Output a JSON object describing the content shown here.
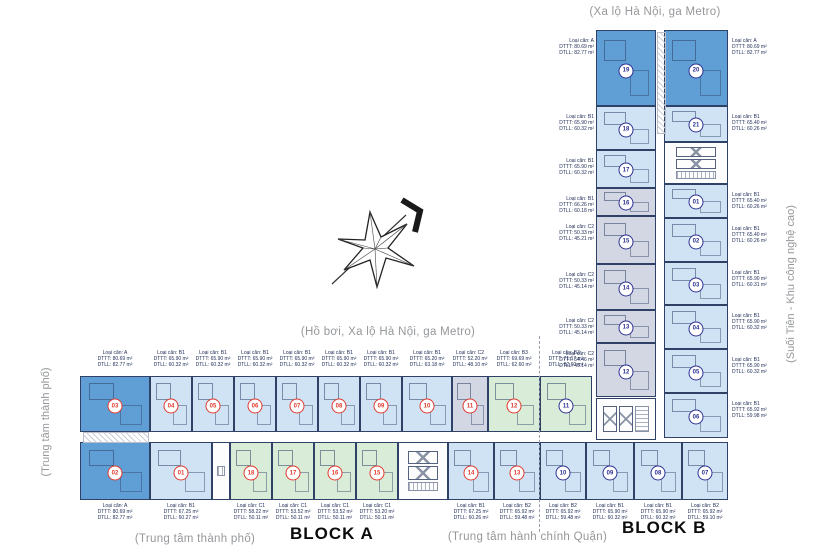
{
  "captions": {
    "top": "(Xa lộ Hà Nội, ga Metro)",
    "mid": "(Hồ bơi, Xa lộ Hà Nội, ga Metro)",
    "side_left": "(Trung tâm thành phố)",
    "side_right": "(Suối Tiên - Khu công nghệ cao)",
    "bottom_left": "(Trung tâm thành phố)",
    "bottom_right": "(Trung tâm hành chính Quận)"
  },
  "colors": {
    "unit_type_a": "#5f9fd6",
    "unit_type_b1": "#cfe3f5",
    "unit_type_c2": "#d3d7e3",
    "unit_type_green": "#d8ecd7",
    "wall": "#2f4166",
    "badge_block_a": "#e03a2f",
    "badge_block_b": "#2e3192",
    "caption_gray": "#95979a"
  },
  "block_a": {
    "label": "BLOCK A",
    "top_units": [
      {
        "n": "03",
        "t": "A",
        "b": "A",
        "w": 70
      },
      {
        "n": "04",
        "t": "B1",
        "b": "A",
        "w": 42
      },
      {
        "n": "05",
        "t": "B1",
        "b": "A",
        "w": 42
      },
      {
        "n": "06",
        "t": "B1",
        "b": "A",
        "w": 42
      },
      {
        "n": "07",
        "t": "B1",
        "b": "A",
        "w": 42
      },
      {
        "n": "08",
        "t": "B1",
        "b": "A",
        "w": 42
      },
      {
        "n": "09",
        "t": "B1",
        "b": "A",
        "w": 42
      },
      {
        "n": "10",
        "t": "B1",
        "b": "A",
        "w": 50
      },
      {
        "n": "11",
        "t": "C2",
        "b": "A",
        "w": 36
      },
      {
        "n": "12",
        "t": "B3",
        "b": "A",
        "w": 52
      },
      {
        "n": "11",
        "t": "B3",
        "b": "B",
        "w": 52
      }
    ],
    "top_labels": [
      {
        "l1": "Loại căn: A",
        "l2": "DTTT: 80.69 m²",
        "l3": "DTLL: 82.77 m²"
      },
      {
        "l1": "Loại căn: B1",
        "l2": "DTTT: 65.90 m²",
        "l3": "DTLL: 60.32 m²"
      },
      {
        "l1": "Loại căn: B1",
        "l2": "DTTT: 65.90 m²",
        "l3": "DTLL: 60.32 m²"
      },
      {
        "l1": "Loại căn: B1",
        "l2": "DTTT: 65.90 m²",
        "l3": "DTLL: 60.32 m²"
      },
      {
        "l1": "Loại căn: B1",
        "l2": "DTTT: 65.90 m²",
        "l3": "DTLL: 60.32 m²"
      },
      {
        "l1": "Loại căn: B1",
        "l2": "DTTT: 65.90 m²",
        "l3": "DTLL: 60.32 m²"
      },
      {
        "l1": "Loại căn: B1",
        "l2": "DTTT: 65.90 m²",
        "l3": "DTLL: 60.32 m²"
      },
      {
        "l1": "Loại căn: B1",
        "l2": "DTTT: 65.20 m²",
        "l3": "DTLL: 63.18 m²"
      },
      {
        "l1": "Loại căn: C2",
        "l2": "DTTT: 52.20 m²",
        "l3": "DTLL: 48.10 m²"
      },
      {
        "l1": "Loại căn: B3",
        "l2": "DTTT: 69.69 m²",
        "l3": "DTLL: 62.60 m²"
      },
      {
        "l1": "Loại căn: B3",
        "l2": "DTTT: 71.17 m²",
        "l3": "DTLL: 62.60 m²"
      }
    ],
    "bottom_units": [
      {
        "n": "02",
        "t": "A",
        "b": "A",
        "w": 70
      },
      {
        "n": "01",
        "t": "B1",
        "b": "A",
        "w": 62
      },
      {
        "core": "stair",
        "w": 18
      },
      {
        "n": "18",
        "t": "C1",
        "b": "A",
        "w": 42
      },
      {
        "n": "17",
        "t": "C1",
        "b": "A",
        "w": 42
      },
      {
        "n": "16",
        "t": "C1",
        "b": "A",
        "w": 42
      },
      {
        "n": "15",
        "t": "C1",
        "b": "A",
        "w": 42
      },
      {
        "core": "lifts",
        "w": 50
      },
      {
        "n": "14",
        "t": "B1",
        "b": "A",
        "w": 46
      },
      {
        "n": "13",
        "t": "B2",
        "b": "A",
        "w": 46
      },
      {
        "n": "10",
        "t": "B2",
        "b": "B",
        "w": 46
      },
      {
        "n": "09",
        "t": "B1",
        "b": "B",
        "w": 48
      },
      {
        "n": "08",
        "t": "B1",
        "b": "B",
        "w": 48
      },
      {
        "n": "07",
        "t": "B2",
        "b": "B",
        "w": 46
      }
    ],
    "bottom_labels": [
      {
        "l1": "Loại căn: A",
        "l2": "DTTT: 80.69 m²",
        "l3": "DTLL: 82.77 m²"
      },
      {
        "l1": "Loại căn: B1",
        "l2": "DTTT: 67.25 m²",
        "l3": "DTLL: 60.27 m²"
      },
      null,
      {
        "l1": "Loại căn: C1",
        "l2": "DTTT: 58.22 m²",
        "l3": "DTLL: 50.11 m²"
      },
      {
        "l1": "Loại căn: C1",
        "l2": "DTTT: 53.52 m²",
        "l3": "DTLL: 50.11 m²"
      },
      {
        "l1": "Loại căn: C1",
        "l2": "DTTT: 53.52 m²",
        "l3": "DTLL: 50.11 m²"
      },
      {
        "l1": "Loại căn: C1",
        "l2": "DTTT: 53.20 m²",
        "l3": "DTLL: 50.11 m²"
      },
      null,
      {
        "l1": "Loại căn: B1",
        "l2": "DTTT: 67.25 m²",
        "l3": "DTLL: 60.26 m²"
      },
      {
        "l1": "Loại căn: B2",
        "l2": "DTTT: 65.92 m²",
        "l3": "DTLL: 59.48 m²"
      },
      {
        "l1": "Loại căn: B2",
        "l2": "DTTT: 65.92 m²",
        "l3": "DTLL: 59.48 m²"
      },
      {
        "l1": "Loại căn: B1",
        "l2": "DTTT: 65.90 m²",
        "l3": "DTLL: 60.32 m²"
      },
      {
        "l1": "Loại căn: B1",
        "l2": "DTTT: 65.90 m²",
        "l3": "DTLL: 60.32 m²"
      },
      {
        "l1": "Loại căn: B2",
        "l2": "DTTT: 65.92 m²",
        "l3": "DTLL: 59.10 m²"
      }
    ]
  },
  "block_b": {
    "label": "BLOCK B",
    "left_rows": [
      {
        "n": "19",
        "t": "A",
        "b": "B",
        "h": 76,
        "lbl": {
          "l1": "Loại căn: A",
          "l2": "DTTT: 80.69 m²",
          "l3": "DTLL: 82.77 m²"
        }
      },
      {
        "n": "18",
        "t": "B1",
        "b": "B",
        "h": 44,
        "lbl": {
          "l1": "Loại căn: B1",
          "l2": "DTTT: 65.90 m²",
          "l3": "DTLL: 60.32 m²"
        }
      },
      {
        "n": "17",
        "t": "B1",
        "b": "B",
        "h": 38,
        "lbl": {
          "l1": "Loại căn: B1",
          "l2": "DTTT: 65.90 m²",
          "l3": "DTLL: 60.32 m²"
        }
      },
      {
        "n": "16",
        "t": "C2",
        "b": "B",
        "h": 28,
        "lbl": {
          "l1": "Loại căn: B1",
          "l2": "DTTT: 66.26 m²",
          "l3": "DTLL: 60.18 m²"
        }
      },
      {
        "n": "15",
        "t": "C2",
        "b": "B",
        "h": 48,
        "lbl": {
          "l1": "Loại căn: C2",
          "l2": "DTTT: 50.33 m²",
          "l3": "DTLL: 45.21 m²"
        }
      },
      {
        "n": "14",
        "t": "C2",
        "b": "B",
        "h": 46,
        "lbl": {
          "l1": "Loại căn: C2",
          "l2": "DTTT: 50.33 m²",
          "l3": "DTLL: 45.14 m²"
        }
      },
      {
        "n": "13",
        "t": "C2",
        "b": "B",
        "h": 33,
        "lbl": {
          "l1": "Loại căn: C2",
          "l2": "DTTT: 50.33 m²",
          "l3": "DTLL: 45.14 m²"
        }
      },
      {
        "n": "12",
        "t": "C2",
        "b": "B",
        "h": 54,
        "lbl": {
          "l1": "Loại căn: C2",
          "l2": "DTTT: 54.46 m²",
          "l3": "DTLL: 45.14 m²"
        }
      }
    ],
    "right_rows": [
      {
        "n": "20",
        "t": "A",
        "b": "B",
        "h": 76,
        "lbl": {
          "l1": "Loại căn: A",
          "l2": "DTTT: 80.69 m²",
          "l3": "DTLL: 82.77 m²"
        }
      },
      {
        "n": "21",
        "t": "B1",
        "b": "B",
        "h": 36,
        "lbl": {
          "l1": "Loại căn: B1",
          "l2": "DTTT: 65.40 m²",
          "l3": "DTLL: 60.26 m²"
        }
      },
      {
        "core": "lifts",
        "h": 42
      },
      {
        "n": "01",
        "t": "B1",
        "b": "B",
        "h": 34,
        "lbl": {
          "l1": "Loại căn: B1",
          "l2": "DTTT: 65.40 m²",
          "l3": "DTLL: 60.26 m²"
        }
      },
      {
        "n": "02",
        "t": "B1",
        "b": "B",
        "h": 44,
        "lbl": {
          "l1": "Loại căn: B1",
          "l2": "DTTT: 65.40 m²",
          "l3": "DTLL: 60.26 m²"
        }
      },
      {
        "n": "03",
        "t": "B1",
        "b": "B",
        "h": 43,
        "lbl": {
          "l1": "Loại căn: B1",
          "l2": "DTTT: 65.90 m²",
          "l3": "DTLL: 60.31 m²"
        }
      },
      {
        "n": "04",
        "t": "B1",
        "b": "B",
        "h": 44,
        "lbl": {
          "l1": "Loại căn: B1",
          "l2": "DTTT: 65.90 m²",
          "l3": "DTLL: 60.32 m²"
        }
      },
      {
        "n": "05",
        "t": "B1",
        "b": "B",
        "h": 44,
        "lbl": {
          "l1": "Loại căn: B1",
          "l2": "DTTT: 65.90 m²",
          "l3": "DTLL: 60.32 m²"
        }
      },
      {
        "n": "06",
        "t": "B1",
        "b": "B",
        "h": 45,
        "lbl": {
          "l1": "Loại căn: B1",
          "l2": "DTTT: 65.92 m²",
          "l3": "DTLL: 59.98 m²"
        }
      }
    ]
  }
}
